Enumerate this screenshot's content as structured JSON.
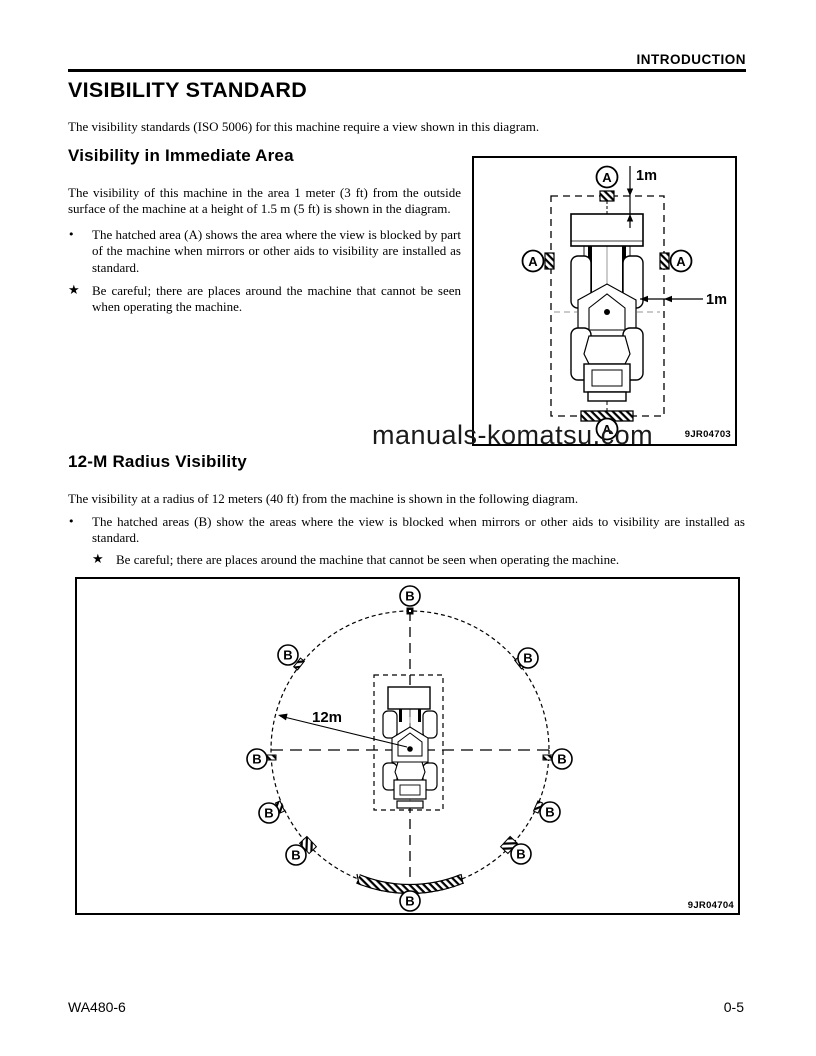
{
  "page": {
    "running_header": "INTRODUCTION",
    "title": "VISIBILITY STANDARD",
    "intro": "The visibility standards (ISO 5006) for this machine require a view shown in this diagram.",
    "watermark": "manuals-komatsu.com",
    "footer_left": "WA480-6",
    "footer_right": "0-5"
  },
  "symbols": {
    "bullet": "•",
    "star": "★"
  },
  "section1": {
    "heading": "Visibility in Immediate Area",
    "paragraph": "The visibility of this machine in the area 1 meter (3 ft) from the outside surface of the machine at a height of 1.5 m (5 ft) is shown in the diagram.",
    "bullet": "The hatched area (A) shows the area where the view is blocked by part of the machine when mirrors or other aids to visibility are installed as standard.",
    "star": "Be careful; there are places around the machine that cannot be seen when operating the machine.",
    "diagram": {
      "label": "A",
      "dim_top": "1m",
      "dim_side": "1m",
      "figure_code": "9JR04703"
    }
  },
  "section2": {
    "heading": "12-M Radius Visibility",
    "paragraph": "The visibility at a radius of 12 meters (40 ft) from the machine is shown in the following diagram.",
    "bullet": "The hatched areas (B) show the areas where the view is blocked when mirrors or other aids to visibility are installed as standard.",
    "star": "Be careful; there are places around the machine that cannot be seen when operating the machine.",
    "diagram": {
      "label": "B",
      "radius_label": "12m",
      "figure_code": "9JR04704"
    }
  }
}
